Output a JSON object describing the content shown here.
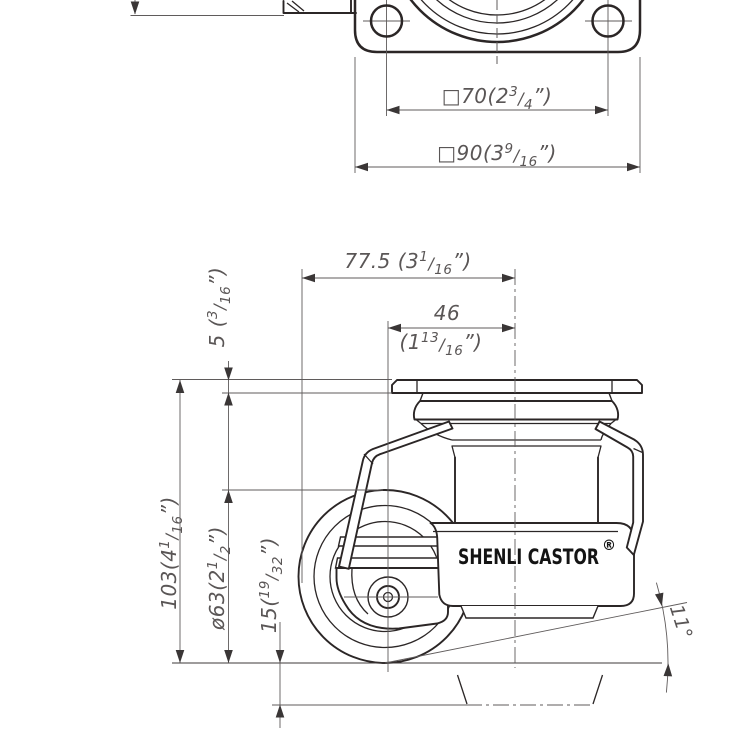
{
  "colors": {
    "line": "#2b2626",
    "dimension": "#5f5b5b",
    "brand_text": "#141414",
    "background": "#ffffff"
  },
  "brand": {
    "name": "SHENLI CASTOR",
    "registered": "®"
  },
  "frac_slash": "/",
  "dims": {
    "plate_inner": {
      "pre": "□70(2",
      "num": "3",
      "den": "4",
      "post": "”)"
    },
    "plate_outer": {
      "pre": "□90(3",
      "num": "9",
      "den": "16",
      "post": "”)"
    },
    "total_offset": {
      "pre": "77.5 (3",
      "num": "1",
      "den": "16",
      "post": "”)"
    },
    "axle_offset_value": "46",
    "axle_offset": {
      "pre": "(1",
      "num": "13",
      "den": "16",
      "post": "”)"
    },
    "plate_thickness": {
      "pre": "5 (",
      "num": "3",
      "den": "16",
      "post": "”)"
    },
    "overall_height": {
      "pre": "103(4",
      "num": "1",
      "den": "16",
      "post": "”)"
    },
    "wheel_diameter": {
      "pre": "ø63(2",
      "num": "1",
      "den": "2",
      "post": "”)"
    },
    "lift_height": {
      "pre": "15(",
      "num": "19",
      "den": "32",
      "post": "”)"
    },
    "tilt_angle": "11°"
  }
}
